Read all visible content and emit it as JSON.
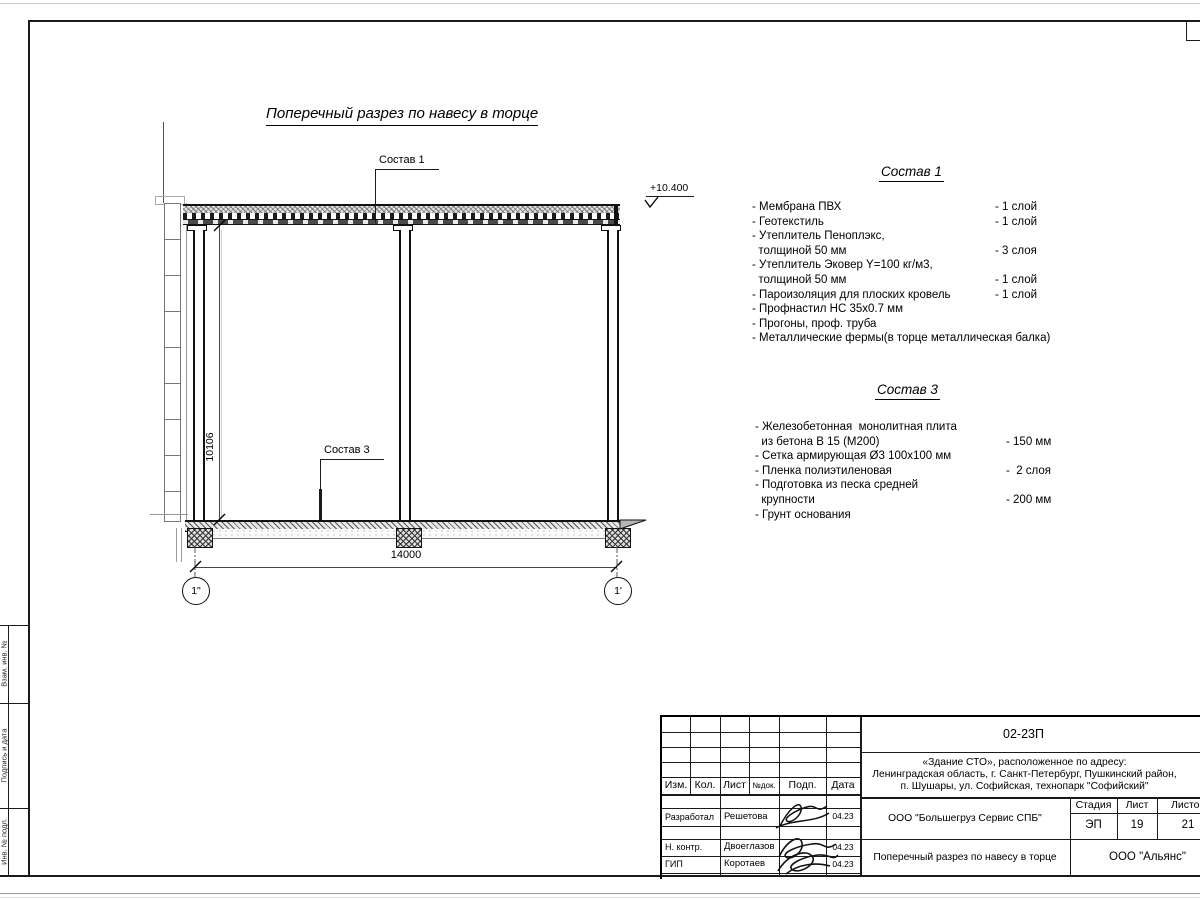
{
  "drawing": {
    "title": "Поперечный разрез по навесу в торце",
    "elevation": "+10.400",
    "callout_roof": "Состав 1",
    "callout_slab": "Состав 3",
    "dim_width": "14000",
    "dim_height": "10106",
    "axis_left": "1\"",
    "axis_right": "1'"
  },
  "sostav1": {
    "title": "Состав 1",
    "items": [
      {
        "name": "- Мембрана ПВХ",
        "value": "- 1 слой"
      },
      {
        "name": "- Геотекстиль",
        "value": "- 1 слой"
      },
      {
        "name": "- Утеплитель Пеноплэкс,",
        "value": ""
      },
      {
        "name": "  толщиной 50 мм",
        "value": "- 3 слоя"
      },
      {
        "name": "- Утеплитель Эковер Y=100 кг/м3,",
        "value": ""
      },
      {
        "name": "  толщиной 50 мм",
        "value": "- 1 слой"
      },
      {
        "name": "- Пароизоляция для плоских кровель",
        "value": "- 1 слой"
      },
      {
        "name": "- Профнастил НС 35x0.7 мм",
        "value": ""
      },
      {
        "name": "- Прогоны, проф. труба",
        "value": ""
      },
      {
        "name": "- Металлические фермы(в торце металлическая балка)",
        "value": ""
      }
    ]
  },
  "sostav3": {
    "title": "Состав 3",
    "items": [
      {
        "name": "- Железобетонная  монолитная плита",
        "value": ""
      },
      {
        "name": "  из бетона В 15 (М200)",
        "value": "- 150 мм"
      },
      {
        "name": "- Сетка армирующая Ø3 100x100 мм",
        "value": ""
      },
      {
        "name": "- Пленка полиэтиленовая",
        "value": "-  2 слоя"
      },
      {
        "name": "- Подготовка из песка средней",
        "value": ""
      },
      {
        "name": "  крупности",
        "value": "- 200 мм"
      },
      {
        "name": "- Грунт основания",
        "value": ""
      }
    ]
  },
  "stamp": {
    "doc_number": "02-23П",
    "object_line1": "«Здание СТО», расположенное по адресу:",
    "object_line2": "Ленинградская область, г. Санкт-Петербург, Пушкинский район,",
    "object_line3": "п. Шушары, ул. Софийская, технопарк \"Софийский\"",
    "col_izm": "Изм.",
    "col_kol": "Кол.",
    "col_list": "Лист",
    "col_dok": "№док.",
    "col_podp": "Подп.",
    "col_data": "Дата",
    "row1_role": "Разработал",
    "row1_name": "Решетова",
    "row1_date": "04.23",
    "row2_role": "Н. контр.",
    "row2_name": "Двоеглазов",
    "row2_date": "04.23",
    "row3_role": "ГИП",
    "row3_name": "Коротаев",
    "row3_date": "04.23",
    "company": "ООО \"Большегруз Сервис СПБ\"",
    "sheet_title": "Поперечный разрез по навесу в торце",
    "stage_label": "Стадия",
    "sheet_label": "Лист",
    "sheets_label": "Листов",
    "stage": "ЭП",
    "sheet": "19",
    "sheets": "21",
    "org": "ООО \"Альянс\""
  },
  "frame": {
    "side_label1": "Взам. инв. №",
    "side_label2": "Подпись и дата",
    "side_label3": "Инв. № подл."
  }
}
